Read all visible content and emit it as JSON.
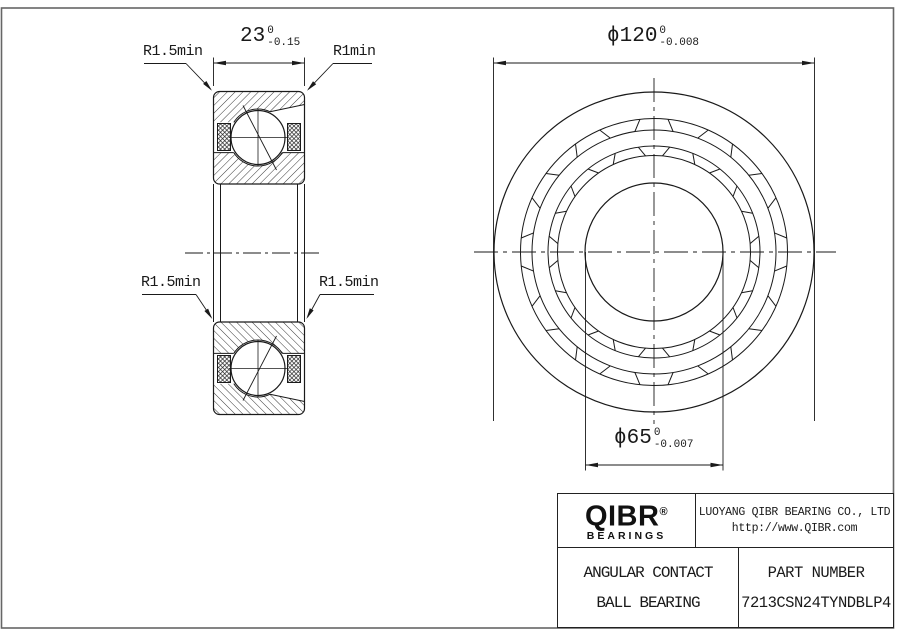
{
  "dimensions": {
    "width": {
      "value": "23",
      "tol_top": "0",
      "tol_bottom": "-0.15"
    },
    "outer_diameter": {
      "prefix": "ϕ",
      "value": "120",
      "tol_top": "0",
      "tol_bottom": "-0.008"
    },
    "bore_diameter": {
      "prefix": "ϕ",
      "value": "65",
      "tol_top": "0",
      "tol_bottom": "-0.007"
    }
  },
  "labels": {
    "chamfer_top_left": "R1.5min",
    "chamfer_top_right": "R1min",
    "chamfer_mid_left": "R1.5min",
    "chamfer_mid_right": "R1.5min"
  },
  "title_block": {
    "logo_text": "QIBR",
    "logo_reg": "®",
    "logo_sub": "BEARINGS",
    "company": "LUOYANG QIBR BEARING CO., LTD",
    "website": "http://www.QIBR.com",
    "product_line1": "ANGULAR CONTACT",
    "product_line2": "BALL BEARING",
    "part_number_label": "PART NUMBER",
    "part_number": "7213CSN24TYNDBLP4"
  },
  "colors": {
    "line": "#1a1a1a",
    "frame": "#666666",
    "background": "#ffffff"
  }
}
